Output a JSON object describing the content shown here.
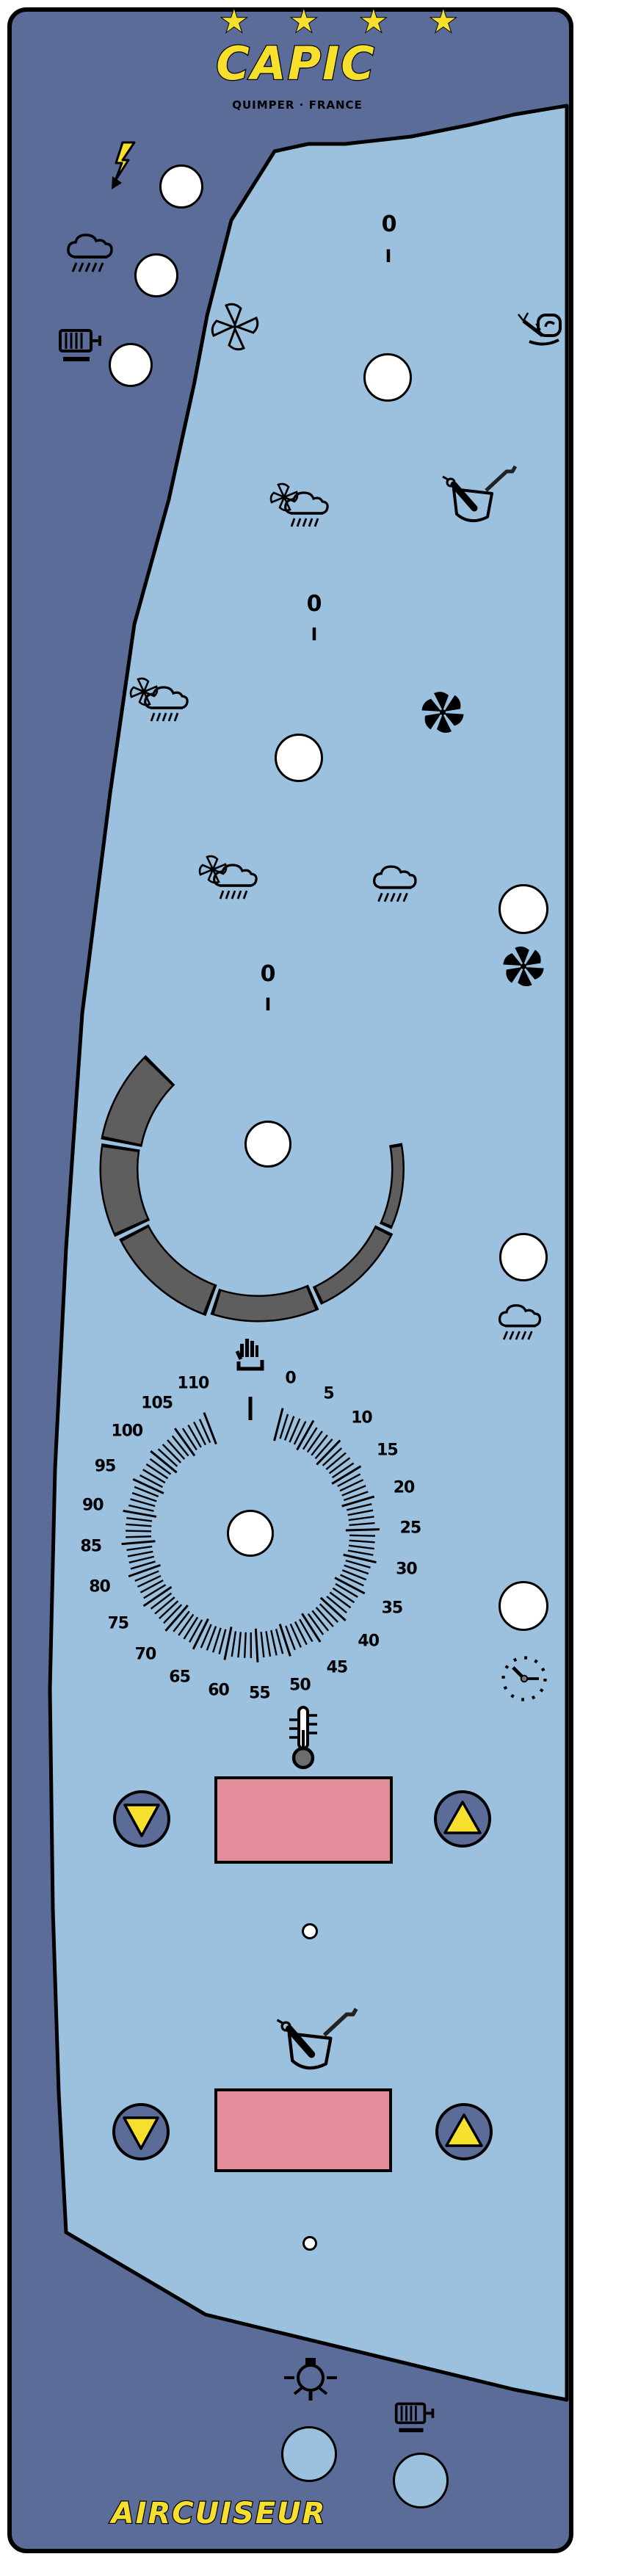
{
  "colors": {
    "panel": "#5b6c99",
    "panel_light": "#9cc1de",
    "display_pink": "#e28d99",
    "accent_yellow": "#f7e02d",
    "arc_gray": "#5e5e5e",
    "outline": "#000000",
    "lamp_white": "#ffffff"
  },
  "brand": {
    "stars": "★ ★ ★ ★",
    "name": "CAPIC",
    "subtitle": "QUIMPER · FRANCE"
  },
  "product": {
    "name": "AIRCUISEUR"
  },
  "power_marks": {
    "off": "0",
    "on": "I"
  },
  "dial": {
    "unit_min": 0,
    "unit_max": 110,
    "labels": [
      "0",
      "5",
      "10",
      "15",
      "20",
      "25",
      "30",
      "35",
      "40",
      "45",
      "50",
      "55",
      "60",
      "65",
      "70",
      "75",
      "80",
      "85",
      "90",
      "95",
      "100",
      "105",
      "110"
    ],
    "manual_symbol": "hand-icon"
  },
  "gauge": {
    "segments": 6
  },
  "icons": {
    "lightning": "⚡",
    "cloud-rain": "🌧",
    "motor": "⚙",
    "fan-outline": "✣",
    "fan-solid": "✺",
    "snail-slow": "🐌",
    "tilting-pan": "🍳",
    "fan-cloud-rain": "≋",
    "hand-manual": "✋",
    "clock-timer": "🕙",
    "thermometer": "🌡",
    "arrow-down": "▼",
    "arrow-up": "▲",
    "light-bulb": "💡"
  }
}
